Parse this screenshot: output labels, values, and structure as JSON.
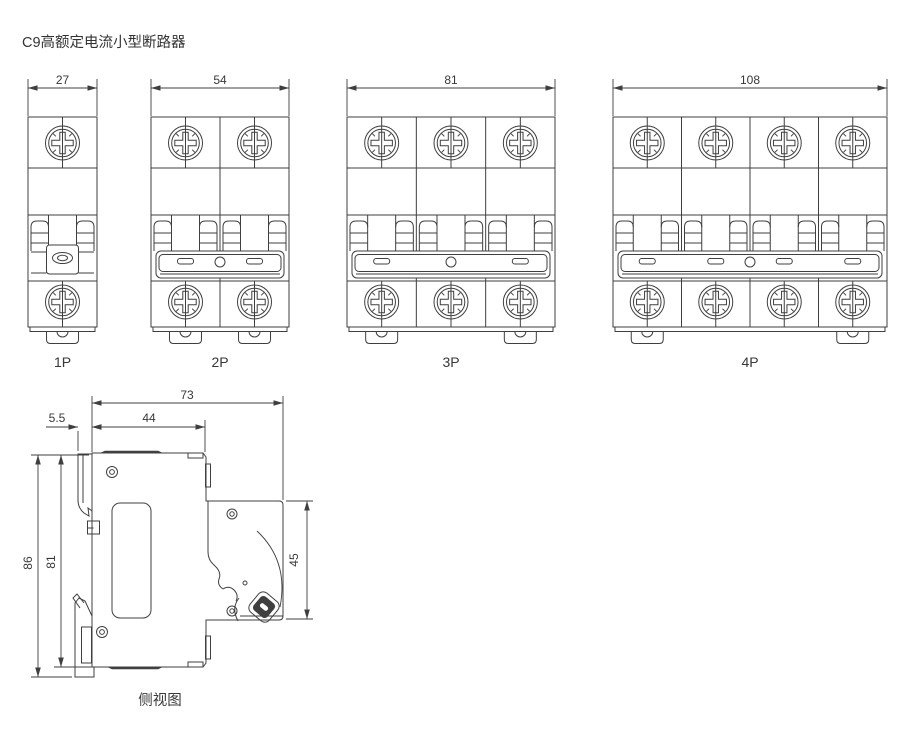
{
  "title": "C9高额定电流小型断路器",
  "colors": {
    "line": "#3f3f3f",
    "text": "#383838",
    "background": "#ffffff"
  },
  "front_views": [
    {
      "label": "1P",
      "dimension": "27",
      "poles": 1
    },
    {
      "label": "2P",
      "dimension": "54",
      "poles": 2
    },
    {
      "label": "3P",
      "dimension": "81",
      "poles": 3
    },
    {
      "label": "4P",
      "dimension": "108",
      "poles": 4
    }
  ],
  "side_view": {
    "label": "侧视图",
    "dimensions": {
      "total_depth": "73",
      "upper_depth": "44",
      "clip_offset": "5.5",
      "total_height": "86",
      "body_height": "81",
      "front_height": "45"
    }
  }
}
